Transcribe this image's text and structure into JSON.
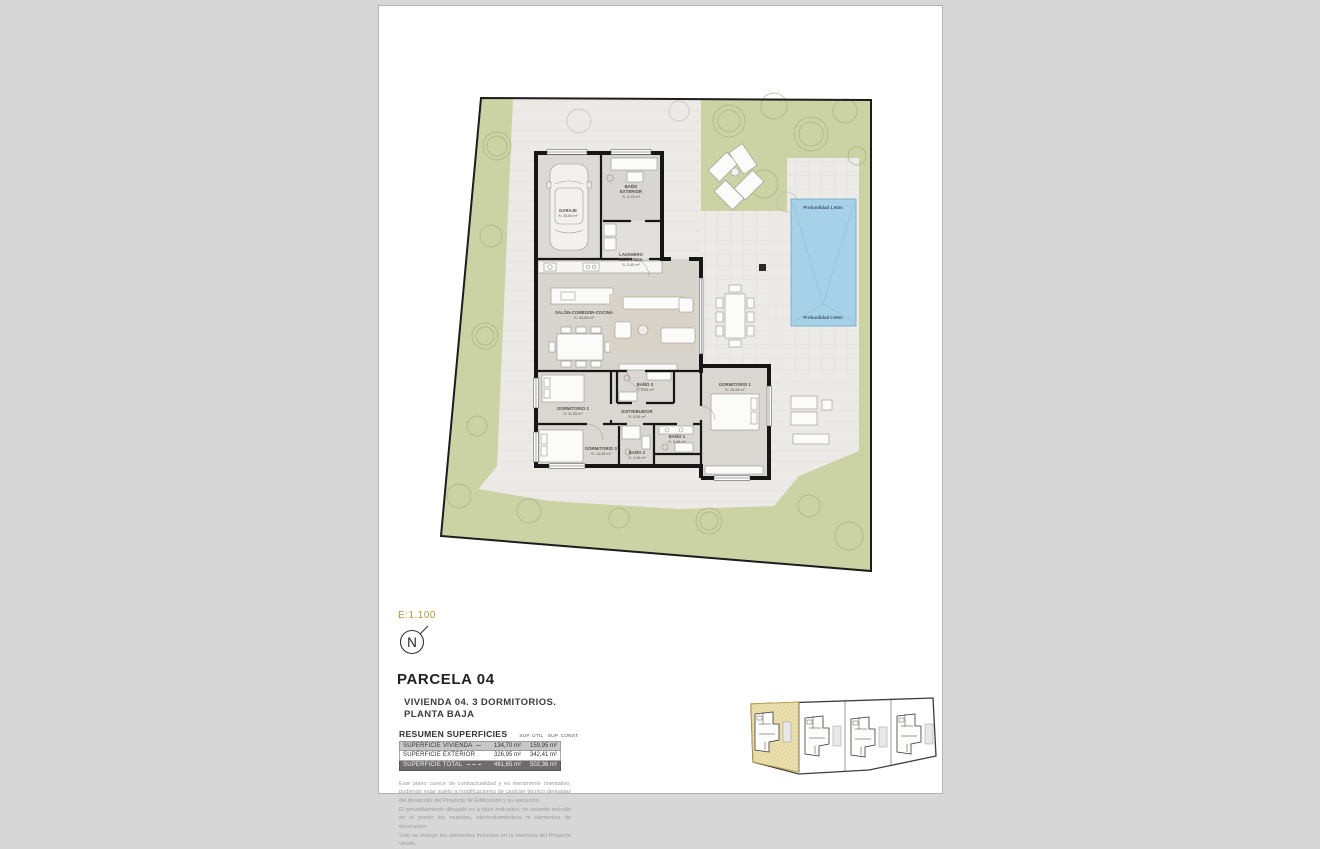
{
  "plan": {
    "pool": {
      "depth_top": "Profundidad 1.60m",
      "depth_bottom": "Profundidad 0.90m"
    },
    "rooms": {
      "garaje": {
        "name": "GARAJE",
        "area": "S: 28,54 m²"
      },
      "bano_exterior": {
        "name_l1": "BAÑO",
        "name_l2": "EXTERIOR",
        "area": "S: 4,13 m²"
      },
      "lavadero": {
        "name_l1": "LAVADERO",
        "name_l2": "DESPENSA",
        "area": "S: 3,45 m²"
      },
      "salon": {
        "name": "SALÓN-COMEDOR-COCINA",
        "area": "S: 44,55 m²"
      },
      "dormitorio1": {
        "name": "DORMITORIO 1",
        "area": "S: 15,08 m²"
      },
      "dormitorio2": {
        "name": "DORMITORIO 2",
        "area": "S: 11,05 m²"
      },
      "dormitorio3": {
        "name": "DORMITORIO 3",
        "area": "S: 14,05 m²"
      },
      "bano1": {
        "name": "BAÑO 1",
        "area": "S: 5,48 m²"
      },
      "bano2": {
        "name": "BAÑO 2",
        "area": "S: 4,15 m²"
      },
      "bano3": {
        "name": "BAÑO 3",
        "area": "S: 5,05 m²"
      },
      "distribuidor": {
        "name": "DISTRIBUIDOR",
        "area": "S: 5,06 m²"
      }
    }
  },
  "info": {
    "scale": "E:1.100",
    "north_letter": "N",
    "parcel_title": "PARCELA 04",
    "subtitle_line1": "VIVIENDA 04. 3 DORMITORIOS.",
    "subtitle_line2": "PLANTA BAJA",
    "table": {
      "title": "RESUMEN SUPERFICIES",
      "col_util": "SUP. ÚTIL",
      "col_const": "SUP. CONST.",
      "rows": [
        {
          "label": "SUPERFICIE VIVIENDA",
          "util": "134,70 m²",
          "const": "159,95 m²"
        },
        {
          "label": "SUPERFICIE EXTERIOR",
          "util": "326,95 m²",
          "const": "342,41 m²"
        },
        {
          "label": "SUPERFICIE TOTAL",
          "util": "461,65 m²",
          "const": "502,36 m²"
        }
      ]
    },
    "disclaimer": [
      "Este plano carece de contractualidad y es meramente orientativo, pudiendo estar sujeto a modificaciones de carácter técnico derivadas del desarrollo del Proyecto de Edificación y su ejecución.",
      "El amueblamiento dibujado es a título indicativo, no estando incluido en el precio los muebles, electrodomésticos ni elementos de decoración.",
      "Solo se incluye los elementos incluidos en la memoria del Proyecto visado."
    ]
  },
  "colors": {
    "accent_gold": "#b1973b",
    "pool_blue": "#a7d1e8",
    "garden_green": "#cbd2a4",
    "highlight_parcel": "#eadfad",
    "wall_black": "#161616"
  }
}
